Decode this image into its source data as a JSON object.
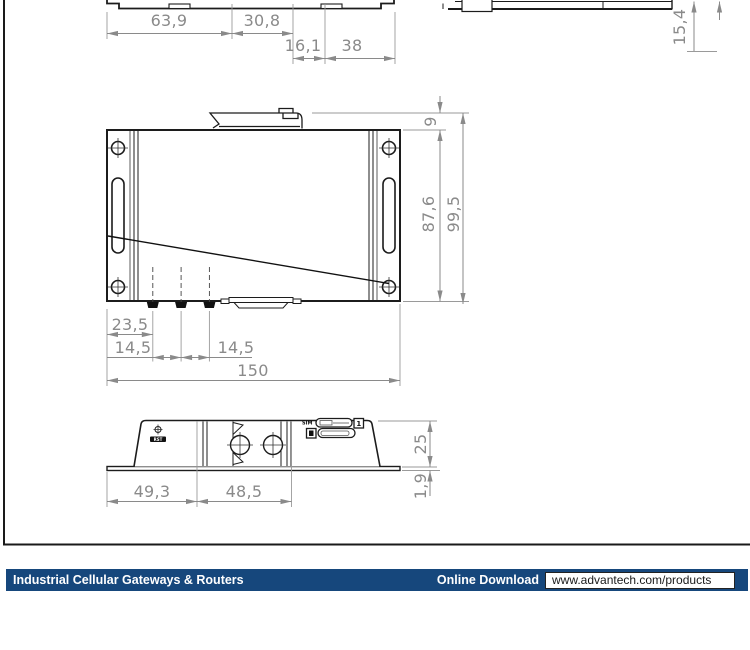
{
  "footer": {
    "category_label": "Industrial Cellular Gateways & Routers",
    "download_label": "Online Download",
    "download_url": "www.advantech.com/products",
    "bar_color": "#16477c"
  },
  "drawing": {
    "dim_color": "#8a8a8a",
    "line_color": "#1c1c1c",
    "dims": {
      "top_width_left": "63,9",
      "top_width_mid": "30,8",
      "top_offset": "16,1",
      "top_width_right": "38",
      "side_height": "15,4",
      "clip_protrusion": "9",
      "body_height": "87,6",
      "total_height": "99,5",
      "ant_offset": "23,5",
      "ant_pitch_1": "14,5",
      "ant_pitch_2": "14,5",
      "total_width": "150",
      "bottom_left": "49,3",
      "bottom_clip_width": "48,5",
      "bottom_height": "25",
      "plate_thickness": "1,9"
    },
    "labels": {
      "sim": "SIM",
      "sim_slot_number": "1",
      "reset": "RST"
    }
  }
}
